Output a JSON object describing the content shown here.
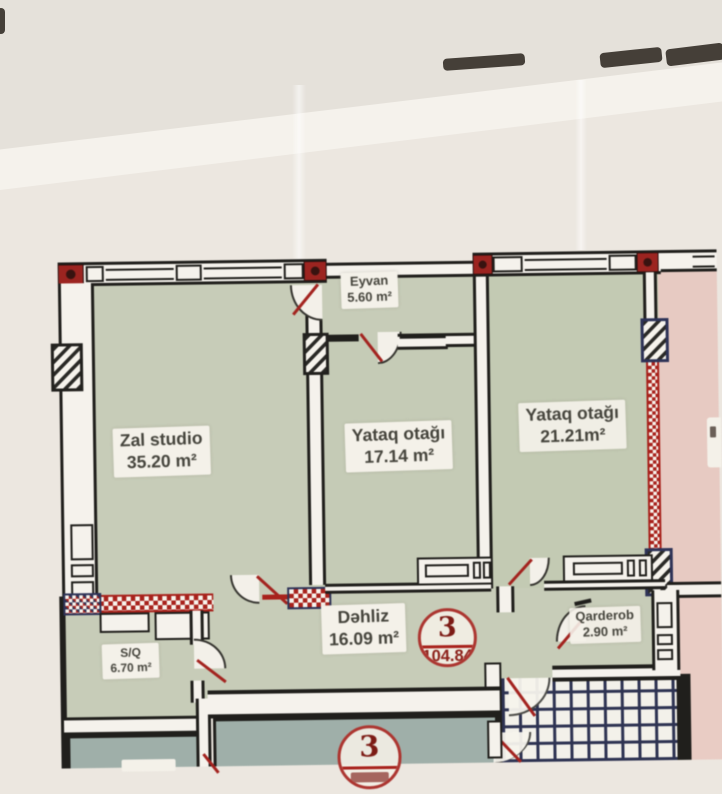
{
  "plan": {
    "rooms": [
      {
        "key": "zal-studio",
        "name": "Zal studio",
        "area": "35.20 m²"
      },
      {
        "key": "eyvan",
        "name": "Eyvan",
        "area": "5.60 m²"
      },
      {
        "key": "yataq-otagi-1",
        "name": "Yataq otağı",
        "area": "17.14 m²"
      },
      {
        "key": "yataq-otagi-2",
        "name": "Yataq otağı",
        "area": "21.21m²"
      },
      {
        "key": "dehliz",
        "name": "Dəhliz",
        "area": "16.09 m²"
      },
      {
        "key": "qarderob",
        "name": "Qarderob",
        "area": "2.90 m²"
      },
      {
        "key": "s-q",
        "name": "S/Q",
        "area": "6.70 m²"
      }
    ],
    "unit_badge": {
      "number": "3",
      "total_area": "104.84"
    },
    "lower_unit_badge": {
      "number": "3"
    }
  },
  "colors": {
    "room_green": "#c6cbb7",
    "room_teal": "#9fafa9",
    "neighbor_pink": "#e7cac2",
    "wall_black": "#201f1c",
    "accent_red": "#a3241e",
    "hatch_navy": "#2e3357",
    "paper": "#ece7e0",
    "label_bg": "#f4f1e9",
    "badge_red": "#ac3530"
  }
}
